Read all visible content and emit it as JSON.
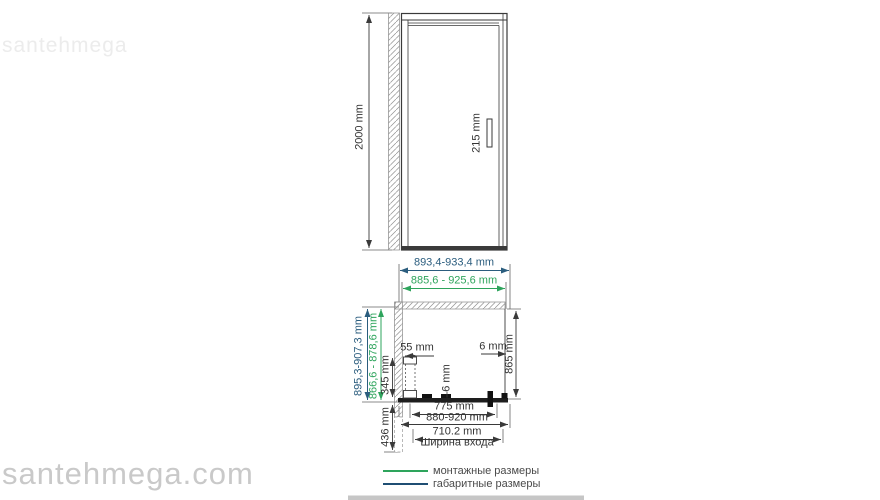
{
  "watermarks": {
    "top": "santehmega",
    "bottom": "santehmega.com"
  },
  "front_view": {
    "height": "2000 mm",
    "handle_height": "215 mm"
  },
  "plan_view": {
    "overall_width": "893,4-933,4 mm",
    "mounting_width": "885,6 - 925,6 mm",
    "overall_depth": "895,3-907,3 mm",
    "mounting_depth": "866,6 - 878,6 mm",
    "wall_profile_width": "55 mm",
    "glass_thickness": "6 mm",
    "wall_gap": "6 mm",
    "inner_depth": "865 mm",
    "side_panel_depth": "345 mm",
    "lower_depth": "436 mm",
    "door_glass_width": "775 mm",
    "adjustment_range": "880-920 mm",
    "entry_width": "710.2 mm",
    "entry_width_caption": "Ширина входа"
  },
  "legend": {
    "items": [
      {
        "label": "монтажные размеры",
        "color": "#2ea45c"
      },
      {
        "label": "габаритные размеры",
        "color": "#1f4e73"
      }
    ]
  },
  "colors": {
    "dimension_navy": "#2b5d7e",
    "dimension_green": "#2ea45c",
    "drawing_line": "#3a3a3a",
    "watermark": "#c9c9c9"
  }
}
